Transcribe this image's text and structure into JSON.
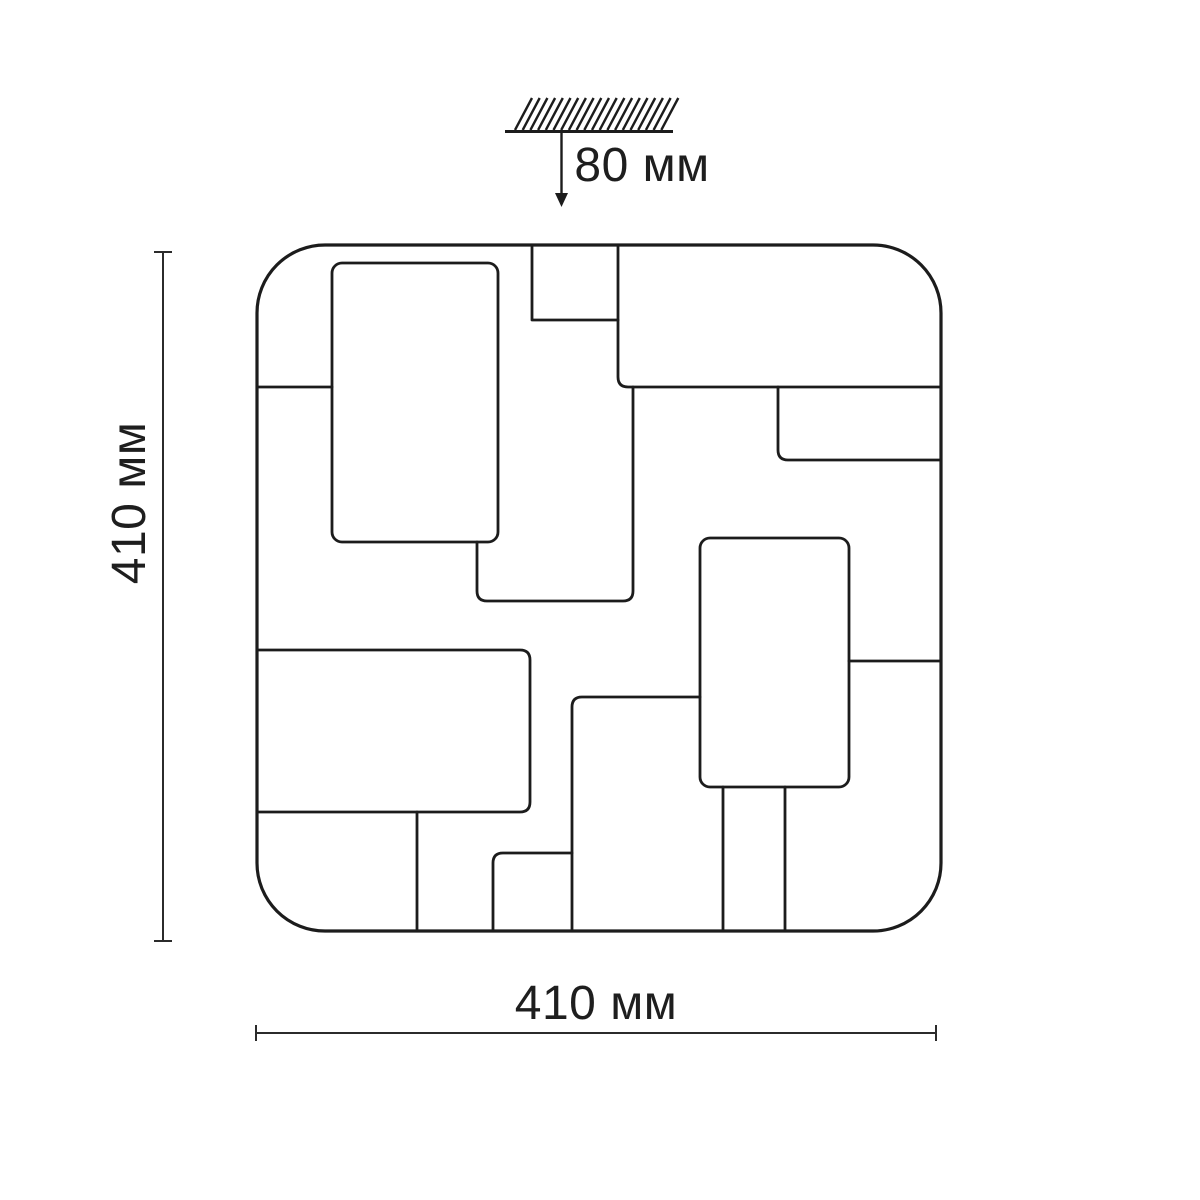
{
  "drawing": {
    "title": "Ceiling light fixture dimensional drawing",
    "labels": {
      "mount_depth": "80 мм",
      "height": "410 мм",
      "width": "410 мм"
    },
    "colors": {
      "background": "#ffffff",
      "outline": "#1c1c1c",
      "dimension": "#2b2b2b",
      "text": "#1e1e1e"
    },
    "ceiling_mount": {
      "hatch": {
        "count": 20,
        "x_start": 515,
        "step": 7.7,
        "y_bottom": 130,
        "y_top": 98,
        "slant": 17,
        "stroke_width": 2.4
      },
      "line": {
        "x1": 505,
        "y1": 131.5,
        "x2": 673,
        "y2": 131.5,
        "stroke_width": 3
      },
      "arrow": {
        "x": 561.5,
        "y1": 131.5,
        "y2": 194,
        "tip_y": 207,
        "head_half_width": 6.5,
        "stroke_width": 2.4
      }
    },
    "fixture": {
      "outline": {
        "x": 257,
        "y": 245,
        "width": 684,
        "height": 686,
        "corner_radius": 68,
        "stroke_width": 3.2
      },
      "panel_stroke_width": 2.8,
      "panels": [
        {
          "name": "top-left-panel",
          "type": "rect",
          "x": 332,
          "y": 263,
          "width": 166,
          "height": 279,
          "rx": 10
        },
        {
          "name": "left-seam",
          "type": "path",
          "d": "M257,387 H332"
        },
        {
          "name": "top-notch",
          "type": "path",
          "d": "M532,245 V320 H618"
        },
        {
          "name": "top-right-seam",
          "type": "path",
          "d": "M618,245 V377 Q618,387 628,387 H941"
        },
        {
          "name": "right-band",
          "type": "path",
          "d": "M778,387 V450 Q778,460 788,460 H941"
        },
        {
          "name": "center-panel",
          "type": "path",
          "d": "M477,542 V591 Q477,601 487,601 H623 Q633,601 633,591 V387"
        },
        {
          "name": "center-right-panel",
          "type": "rect",
          "x": 700,
          "y": 538,
          "width": 149,
          "height": 249,
          "rx": 10
        },
        {
          "name": "right-seam",
          "type": "path",
          "d": "M849,661 H941"
        },
        {
          "name": "lower-middle-seam",
          "type": "path",
          "d": "M700,697 H582 Q572,697 572,707 V931"
        },
        {
          "name": "bottom-small-panel",
          "type": "path",
          "d": "M572,853 H503 Q493,853 493,863 V931"
        },
        {
          "name": "bottom-left-panel",
          "type": "path",
          "d": "M257,650 H520 Q530,650 530,660 V802 Q530,812 520,812 H257"
        },
        {
          "name": "bottom-left-seam",
          "type": "path",
          "d": "M417,812 V931"
        },
        {
          "name": "leg-left-seam",
          "type": "path",
          "d": "M723,787 V931"
        },
        {
          "name": "leg-right-seam",
          "type": "path",
          "d": "M785,787 V931"
        }
      ]
    },
    "dimensions": {
      "height_line": {
        "x": 163,
        "y1": 252,
        "y2": 941,
        "tick_half": 9,
        "stroke_width": 2
      },
      "width_line": {
        "y": 1033,
        "x1": 256,
        "x2": 936,
        "tick_half": 8,
        "stroke_width": 2
      }
    }
  }
}
